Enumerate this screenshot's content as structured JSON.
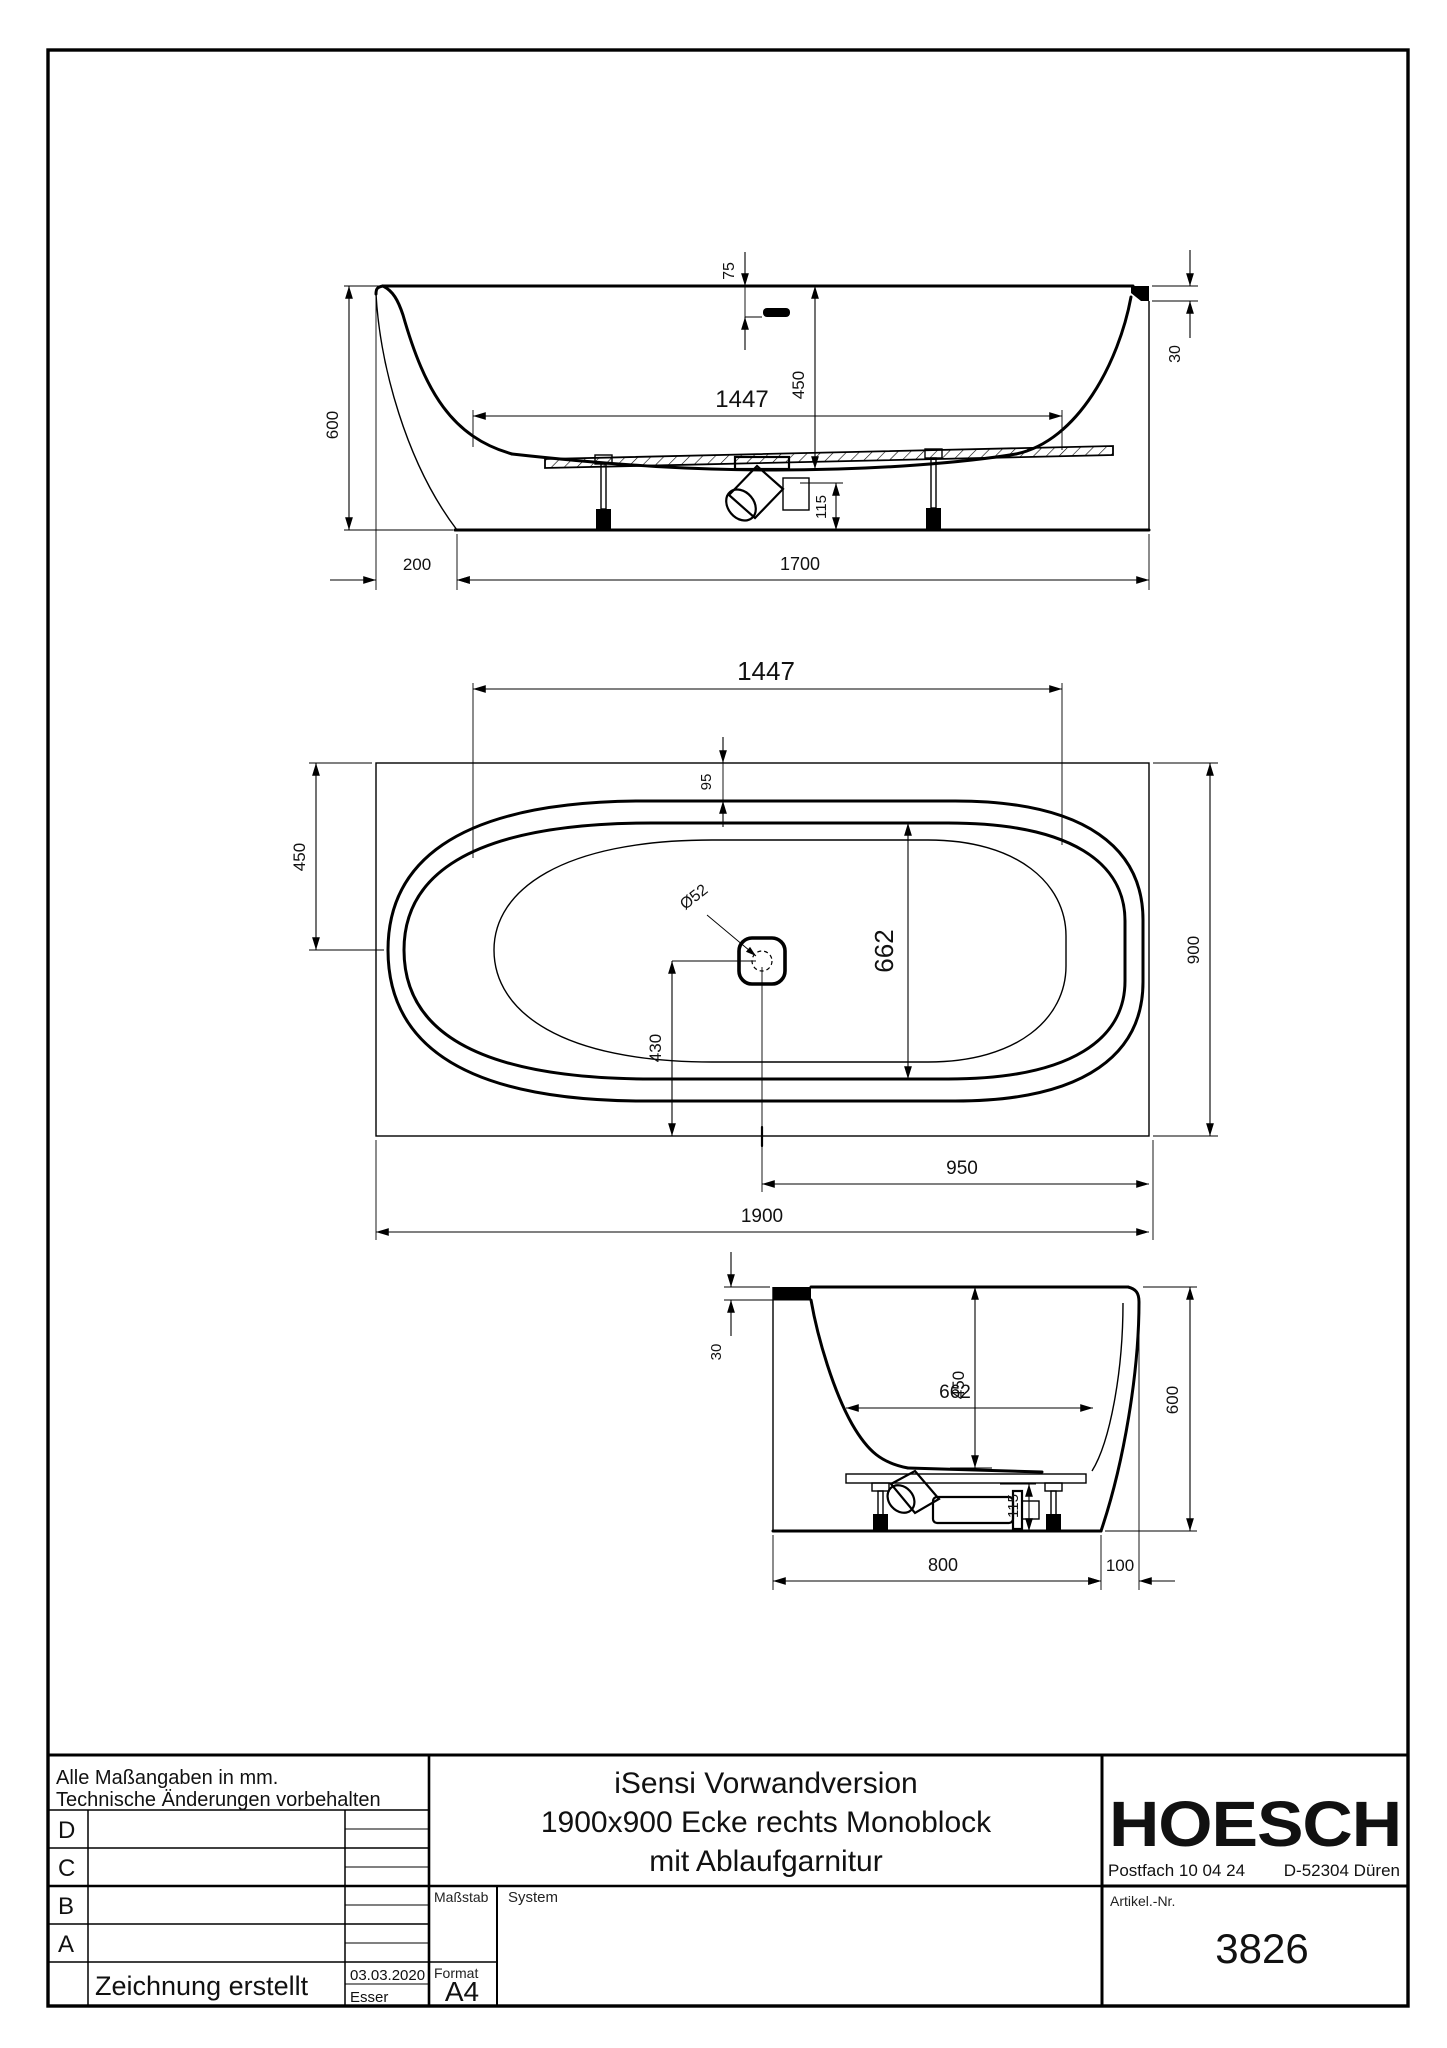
{
  "views": {
    "side": {
      "dims": {
        "height": "600",
        "offset": "200",
        "length": "1700",
        "inner_length": "1447",
        "depth": "450",
        "overflow": "75",
        "rim": "30",
        "drain_height": "115"
      }
    },
    "plan": {
      "dims": {
        "inner_length": "1447",
        "center_offset": "450",
        "rim_width": "95",
        "drain_dia": "Ø52",
        "opening_width": "662",
        "drain_from_edge": "430",
        "drain_from_right": "950",
        "total_length": "1900",
        "total_width": "900"
      }
    },
    "end": {
      "dims": {
        "rim": "30",
        "opening_width": "662",
        "depth": "450",
        "height": "600",
        "drain_height": "115",
        "inner_width": "800",
        "offset": "100"
      }
    }
  },
  "title_block": {
    "notes": [
      "Alle Maßangaben in mm.",
      "Technische Änderungen vorbehalten"
    ],
    "revision_rows": [
      "D",
      "C",
      "B",
      "A"
    ],
    "created_label": "Zeichnung erstellt",
    "created_date": "03.03.2020",
    "created_by": "Esser",
    "scale_label": "Maßstab",
    "system_label": "System",
    "format_label": "Format",
    "format_value": "A4",
    "title_lines": [
      "iSensi Vorwandversion",
      "1900x900 Ecke rechts Monoblock",
      "mit Ablaufgarnitur"
    ],
    "brand": "HOESCH",
    "address": "Postfach 10 04 24",
    "city": "D-52304 Düren",
    "article_label": "Artikel.-Nr.",
    "article_number": "3826"
  }
}
